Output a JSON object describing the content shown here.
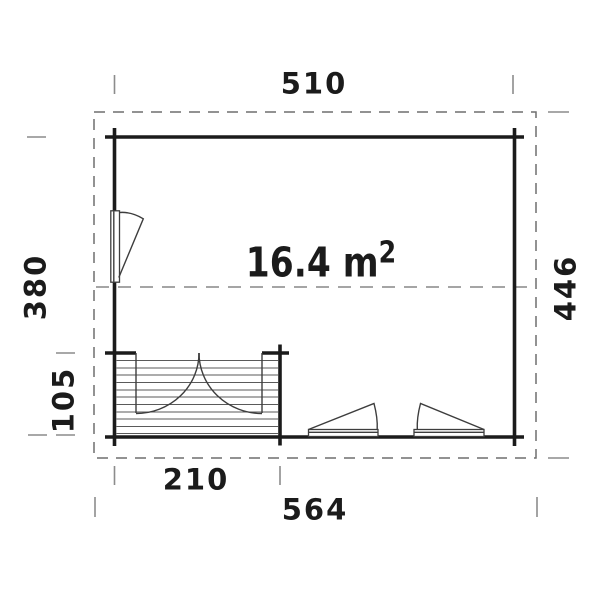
{
  "figure": {
    "type": "floor-plan",
    "area_label": {
      "value": "16.4 m",
      "superscript": "2"
    },
    "dimensions": {
      "wall_width": "510",
      "wall_depth": "380",
      "terrace_depth": "105",
      "overall_depth": "446",
      "terrace_width": "210",
      "overall_width": "564"
    },
    "colors": {
      "background": "#ffffff",
      "wall_line": "#1b1b1b",
      "detail_line": "#3d3d3d",
      "hatch_line": "#5a5a5a",
      "dashed_line": "#6f6f6f",
      "tick_line": "#8c8c8c",
      "label_text": "#1b1b1b"
    }
  }
}
